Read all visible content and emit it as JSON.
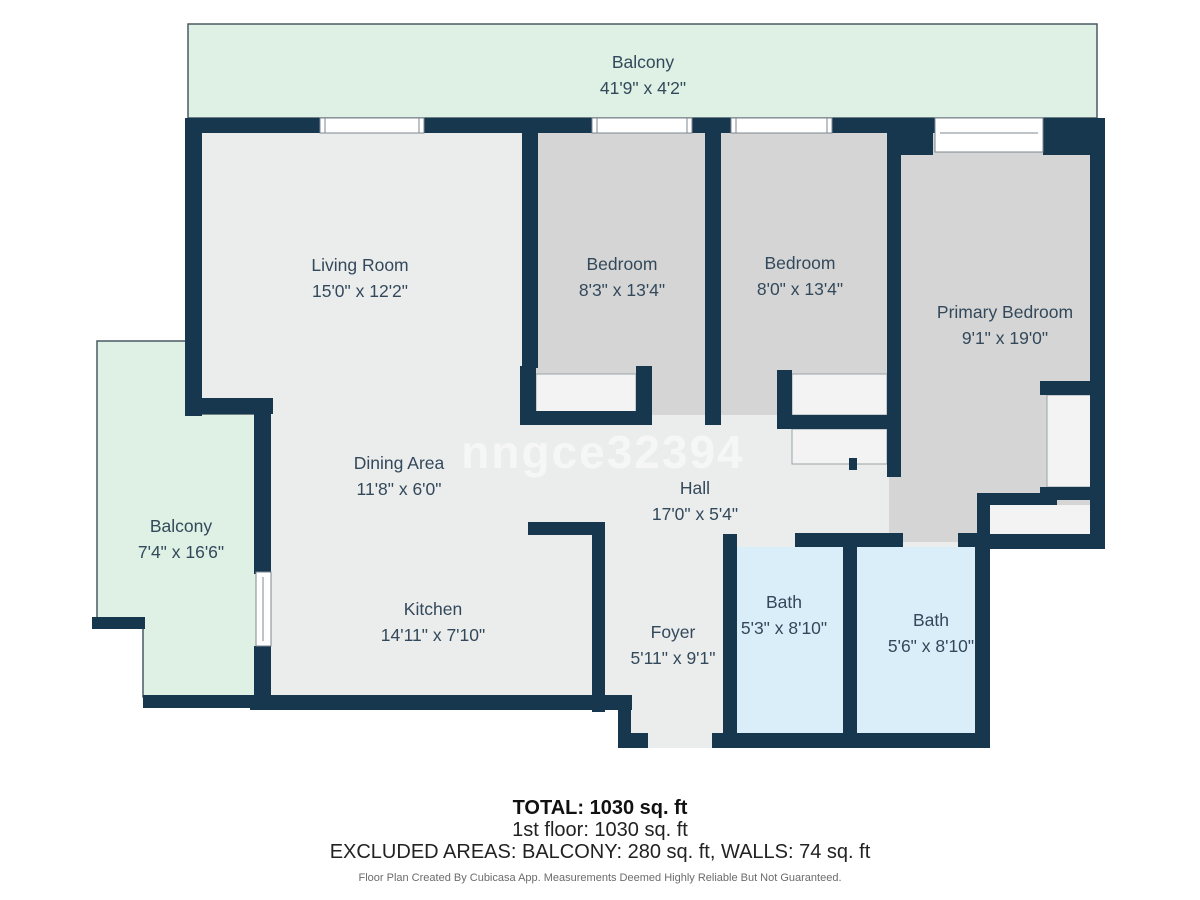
{
  "plan": {
    "watermark": "nngce32394",
    "rooms": [
      {
        "name": "Balcony",
        "dims": "41'9\" x 4'2\""
      },
      {
        "name": "Living Room",
        "dims": "15'0\" x 12'2\""
      },
      {
        "name": "Bedroom",
        "dims": "8'3\" x 13'4\""
      },
      {
        "name": "Bedroom",
        "dims": "8'0\" x 13'4\""
      },
      {
        "name": "Primary Bedroom",
        "dims": "9'1\" x 19'0\""
      },
      {
        "name": "Balcony",
        "dims": "7'4\" x 16'6\""
      },
      {
        "name": "Dining Area",
        "dims": "11'8\" x 6'0\""
      },
      {
        "name": "Hall",
        "dims": "17'0\" x 5'4\""
      },
      {
        "name": "Kitchen",
        "dims": "14'11\" x 7'10\""
      },
      {
        "name": "Foyer",
        "dims": "5'11\" x 9'1\""
      },
      {
        "name": "Bath",
        "dims": "5'3\" x 8'10\""
      },
      {
        "name": "Bath",
        "dims": "5'6\" x 8'10\""
      }
    ],
    "summary": {
      "total": "TOTAL: 1030 sq. ft",
      "floor1": "1st floor: 1030 sq. ft",
      "excluded": "EXCLUDED AREAS: BALCONY: 280 sq. ft, WALLS: 74 sq. ft",
      "disclaimer": "Floor Plan Created By Cubicasa App. Measurements Deemed Highly Reliable But Not Guaranteed."
    },
    "colors": {
      "wall": "#17374f",
      "floor": "#ebecec",
      "bedroom_floor": "#d4d5d4",
      "bath_floor": "#daeef9",
      "balcony_floor": "#def1e4",
      "closet": "#f2f3f2",
      "label": "#33495b",
      "outline": "#4a5a64"
    }
  }
}
